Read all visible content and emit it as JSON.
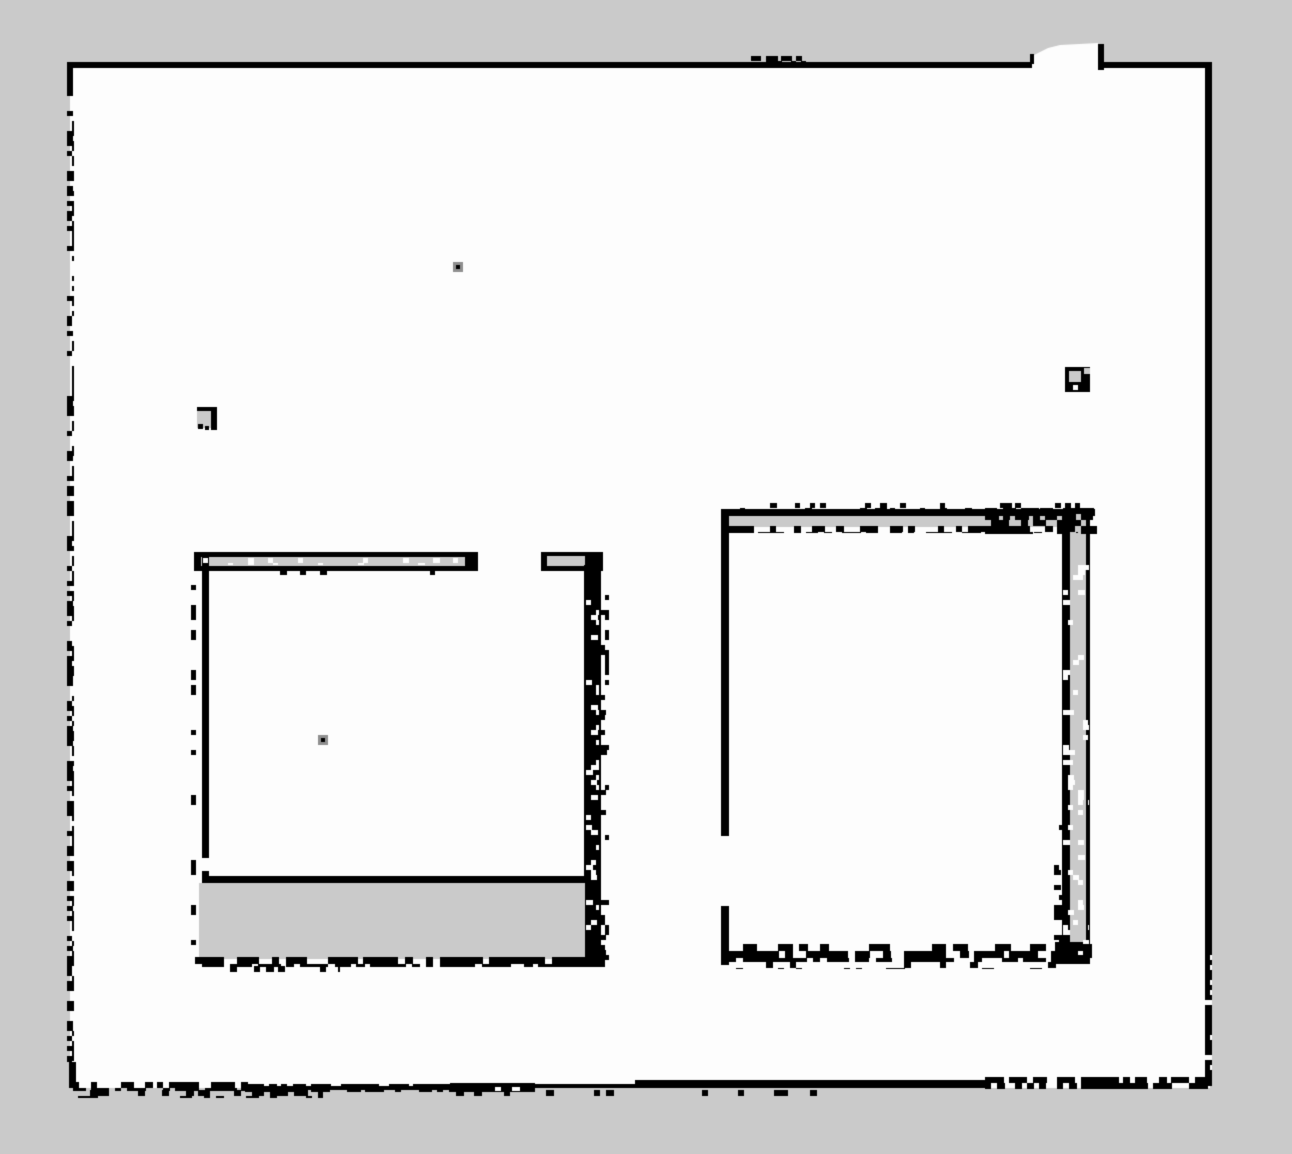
{
  "map": {
    "kind": "occupancy-grid",
    "canvas": {
      "width": 1292,
      "height": 1154
    },
    "colors": {
      "unknown": "#cacaca",
      "free": "#fdfdfd",
      "occupied": "#000000",
      "halo": "#8f8f8f"
    },
    "free_area": {
      "x": 70,
      "y": 63,
      "w": 1140,
      "h": 1025
    },
    "notch_polygon": [
      [
        1032,
        70
      ],
      [
        1032,
        56
      ],
      [
        1048,
        48
      ],
      [
        1060,
        45
      ],
      [
        1098,
        43
      ],
      [
        1098,
        70
      ]
    ],
    "rects": [
      {
        "name": "top-wall-left",
        "x": 68,
        "y": 62,
        "w": 964,
        "h": 6,
        "c": "occupied"
      },
      {
        "name": "top-wall-right",
        "x": 1098,
        "y": 62,
        "w": 112,
        "h": 6,
        "c": "occupied"
      },
      {
        "name": "notch-right-edge",
        "x": 1098,
        "y": 44,
        "w": 6,
        "h": 26,
        "c": "occupied"
      },
      {
        "name": "notch-left-tick",
        "x": 1030,
        "y": 54,
        "w": 4,
        "h": 10,
        "c": "occupied"
      },
      {
        "name": "right-outer-wall",
        "x": 1205,
        "y": 62,
        "w": 7,
        "h": 1024,
        "c": "occupied"
      },
      {
        "name": "left-outer-wall-top",
        "x": 67,
        "y": 62,
        "w": 6,
        "h": 34,
        "c": "occupied"
      },
      {
        "name": "left-outer-wall-bottom",
        "x": 69,
        "y": 1062,
        "w": 7,
        "h": 26,
        "c": "occupied"
      },
      {
        "name": "left-room-band-a-black",
        "x": 194,
        "y": 552,
        "w": 284,
        "h": 19,
        "c": "occupied"
      },
      {
        "name": "left-room-band-a-gray",
        "x": 201,
        "y": 557,
        "w": 264,
        "h": 9,
        "c": "unknown"
      },
      {
        "name": "left-room-band-b-black",
        "x": 541,
        "y": 552,
        "w": 62,
        "h": 19,
        "c": "occupied"
      },
      {
        "name": "left-room-band-b-gray",
        "x": 547,
        "y": 556,
        "w": 38,
        "h": 10,
        "c": "unknown"
      },
      {
        "name": "left-room-left-wall-upper",
        "x": 202,
        "y": 557,
        "w": 7,
        "h": 301,
        "c": "occupied"
      },
      {
        "name": "left-room-left-wall-lower",
        "x": 202,
        "y": 871,
        "w": 7,
        "h": 93,
        "c": "occupied"
      },
      {
        "name": "left-room-right-wall",
        "x": 584,
        "y": 565,
        "w": 17,
        "h": 399,
        "c": "occupied"
      },
      {
        "name": "left-room-inner-bottom",
        "x": 203,
        "y": 876,
        "w": 387,
        "h": 7,
        "c": "occupied"
      },
      {
        "name": "left-room-gray-band",
        "x": 199,
        "y": 883,
        "w": 386,
        "h": 76,
        "c": "unknown"
      },
      {
        "name": "right-room-top-line",
        "x": 721,
        "y": 509,
        "w": 374,
        "h": 7,
        "c": "occupied"
      },
      {
        "name": "right-room-top-gray",
        "x": 728,
        "y": 516,
        "w": 346,
        "h": 11,
        "c": "unknown"
      },
      {
        "name": "right-room-left-wall-upper",
        "x": 721,
        "y": 513,
        "w": 8,
        "h": 323,
        "c": "occupied"
      },
      {
        "name": "right-room-left-wall-lower",
        "x": 721,
        "y": 906,
        "w": 8,
        "h": 59,
        "c": "occupied"
      },
      {
        "name": "right-room-left-stub",
        "x": 721,
        "y": 526,
        "w": 28,
        "h": 7,
        "c": "occupied"
      },
      {
        "name": "right-room-right-strip",
        "x": 1062,
        "y": 513,
        "w": 8,
        "h": 330,
        "c": "occupied"
      },
      {
        "name": "right-room-right-strip-lower",
        "x": 1062,
        "y": 843,
        "w": 9,
        "h": 119,
        "c": "occupied"
      },
      {
        "name": "right-room-right-gray-col",
        "x": 1070,
        "y": 513,
        "w": 16,
        "h": 449,
        "c": "unknown"
      },
      {
        "name": "right-room-right-outer-line",
        "x": 1086,
        "y": 513,
        "w": 4,
        "h": 449,
        "c": "occupied"
      },
      {
        "name": "right-room-bottom-corner",
        "x": 1055,
        "y": 942,
        "w": 35,
        "h": 22,
        "c": "occupied"
      },
      {
        "name": "bottom-wall-thick-a",
        "x": 450,
        "y": 1083,
        "w": 85,
        "h": 9,
        "c": "occupied"
      },
      {
        "name": "bottom-wall-hole-1",
        "x": 495,
        "y": 1087,
        "w": 6,
        "h": 4,
        "c": "free"
      },
      {
        "name": "bottom-wall-hole-2",
        "x": 512,
        "y": 1087,
        "w": 8,
        "h": 4,
        "c": "free"
      },
      {
        "name": "bottom-wall-thin-a",
        "x": 260,
        "y": 1086,
        "w": 190,
        "h": 4,
        "c": "occupied"
      },
      {
        "name": "bottom-wall-thin-b",
        "x": 530,
        "y": 1084,
        "w": 108,
        "h": 4,
        "c": "occupied"
      },
      {
        "name": "bottom-wall-thick-b",
        "x": 635,
        "y": 1080,
        "w": 350,
        "h": 8,
        "c": "occupied"
      },
      {
        "name": "left-square-mark-gray",
        "x": 197,
        "y": 409,
        "w": 17,
        "h": 19,
        "c": "unknown"
      },
      {
        "name": "left-square-mark-top",
        "x": 197,
        "y": 407,
        "w": 19,
        "h": 4,
        "c": "occupied"
      },
      {
        "name": "left-square-mark-right",
        "x": 211,
        "y": 407,
        "w": 6,
        "h": 23,
        "c": "occupied"
      },
      {
        "name": "left-square-mark-dot-1",
        "x": 198,
        "y": 424,
        "w": 5,
        "h": 5,
        "c": "occupied"
      },
      {
        "name": "left-square-mark-dot-2",
        "x": 205,
        "y": 426,
        "w": 4,
        "h": 4,
        "c": "occupied"
      },
      {
        "name": "right-square-mark-black",
        "x": 1065,
        "y": 367,
        "w": 25,
        "h": 25,
        "c": "occupied"
      },
      {
        "name": "right-square-mark-gray",
        "x": 1069,
        "y": 371,
        "w": 12,
        "h": 11,
        "c": "unknown"
      },
      {
        "name": "right-square-mark-white",
        "x": 1073,
        "y": 385,
        "w": 5,
        "h": 5,
        "c": "free"
      },
      {
        "name": "right-square-mark-nick",
        "x": 1084,
        "y": 368,
        "w": 6,
        "h": 6,
        "c": "unknown"
      },
      {
        "name": "dot-a-halo",
        "x": 453,
        "y": 262,
        "w": 10,
        "h": 10,
        "c": "halo"
      },
      {
        "name": "dot-a-core",
        "x": 456,
        "y": 265,
        "w": 4,
        "h": 4,
        "c": "occupied"
      },
      {
        "name": "dot-b-halo",
        "x": 318,
        "y": 735,
        "w": 10,
        "h": 10,
        "c": "halo"
      },
      {
        "name": "dot-b-core",
        "x": 321,
        "y": 738,
        "w": 4,
        "h": 4,
        "c": "occupied"
      }
    ],
    "noise": [
      {
        "name": "left-wall-dotted",
        "x": 67,
        "y": 96,
        "w": 7,
        "h": 966,
        "cell": 5,
        "density": 0.45,
        "c": "occupied",
        "seed": 11
      },
      {
        "name": "bottom-left-dashes",
        "x": 73,
        "y": 1082,
        "w": 175,
        "h": 9,
        "cell": 6,
        "density": 0.55,
        "c": "occupied",
        "seed": 12
      },
      {
        "name": "bottom-left-below-blobs",
        "x": 78,
        "y": 1090,
        "w": 245,
        "h": 8,
        "cell": 6,
        "density": 0.28,
        "c": "occupied",
        "seed": 13
      },
      {
        "name": "bottom-mid-noise",
        "x": 245,
        "y": 1084,
        "w": 205,
        "h": 8,
        "cell": 6,
        "density": 0.6,
        "c": "occupied",
        "seed": 14
      },
      {
        "name": "bottom-right-noise",
        "x": 985,
        "y": 1077,
        "w": 223,
        "h": 12,
        "cell": 6,
        "density": 0.68,
        "c": "occupied",
        "seed": 15
      },
      {
        "name": "bottom-mid-below",
        "x": 450,
        "y": 1090,
        "w": 420,
        "h": 6,
        "cell": 6,
        "density": 0.18,
        "c": "occupied",
        "seed": 16
      },
      {
        "name": "top-wall-bumps",
        "x": 746,
        "y": 56,
        "w": 60,
        "h": 7,
        "cell": 5,
        "density": 0.55,
        "c": "occupied",
        "seed": 17
      },
      {
        "name": "right-wall-white-specks",
        "x": 1205,
        "y": 950,
        "w": 7,
        "h": 120,
        "cell": 5,
        "density": 0.2,
        "c": "free",
        "seed": 18
      },
      {
        "name": "band-a-white-specks",
        "x": 203,
        "y": 558,
        "w": 260,
        "h": 7,
        "cell": 5,
        "density": 0.12,
        "c": "free",
        "seed": 19
      },
      {
        "name": "left-room-dot-column",
        "x": 191,
        "y": 560,
        "w": 5,
        "h": 400,
        "cell": 5,
        "density": 0.28,
        "c": "occupied",
        "seed": 20
      },
      {
        "name": "band-a-under-ticks",
        "x": 210,
        "y": 570,
        "w": 260,
        "h": 5,
        "cell": 5,
        "density": 0.1,
        "c": "occupied",
        "seed": 21
      },
      {
        "name": "left-room-right-wall-blobs",
        "x": 600,
        "y": 590,
        "w": 9,
        "h": 370,
        "cell": 5,
        "density": 0.22,
        "c": "occupied",
        "seed": 22
      },
      {
        "name": "left-room-right-wall-white",
        "x": 586,
        "y": 600,
        "w": 13,
        "h": 355,
        "cell": 5,
        "density": 0.16,
        "c": "free",
        "seed": 23
      },
      {
        "name": "left-room-bottom-line",
        "x": 195,
        "y": 957,
        "w": 410,
        "h": 10,
        "cell": 7,
        "density": 0.78,
        "c": "occupied",
        "seed": 24
      },
      {
        "name": "left-room-bottom-below",
        "x": 200,
        "y": 966,
        "w": 140,
        "h": 6,
        "cell": 6,
        "density": 0.25,
        "c": "occupied",
        "seed": 25
      },
      {
        "name": "right-room-band-bottom",
        "x": 728,
        "y": 526,
        "w": 350,
        "h": 7,
        "cell": 6,
        "density": 0.55,
        "c": "occupied",
        "seed": 26
      },
      {
        "name": "right-room-band-right-mess",
        "x": 985,
        "y": 508,
        "w": 112,
        "h": 26,
        "cell": 6,
        "density": 0.5,
        "c": "occupied",
        "seed": 27
      },
      {
        "name": "right-room-ticks-above",
        "x": 735,
        "y": 503,
        "w": 345,
        "h": 7,
        "cell": 5,
        "density": 0.22,
        "c": "occupied",
        "seed": 28
      },
      {
        "name": "right-wall-col-white",
        "x": 1063,
        "y": 560,
        "w": 26,
        "h": 395,
        "cell": 5,
        "density": 0.12,
        "c": "free",
        "seed": 29
      },
      {
        "name": "right-wall-left-dots",
        "x": 1054,
        "y": 820,
        "w": 8,
        "h": 140,
        "cell": 5,
        "density": 0.28,
        "c": "occupied",
        "seed": 30
      },
      {
        "name": "right-room-bottom-band",
        "x": 722,
        "y": 944,
        "w": 370,
        "h": 18,
        "cell": 7,
        "density": 0.58,
        "c": "occupied",
        "seed": 31
      },
      {
        "name": "right-room-bottom-below",
        "x": 730,
        "y": 962,
        "w": 350,
        "h": 7,
        "cell": 6,
        "density": 0.16,
        "c": "occupied",
        "seed": 32
      }
    ]
  }
}
